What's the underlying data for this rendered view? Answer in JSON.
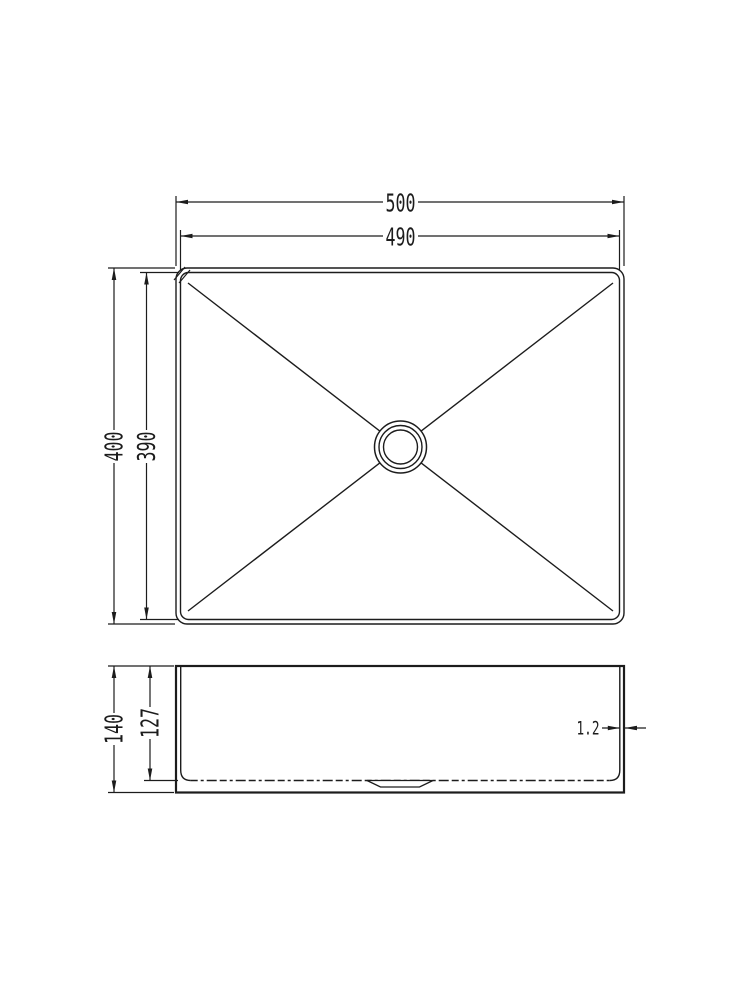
{
  "drawing": {
    "type": "technical-dimension-drawing",
    "subject": "rectangular-sink",
    "colors": {
      "line": "#1c1c1c",
      "background": "#ffffff"
    },
    "top_view": {
      "dim_outer_width": "500",
      "dim_inner_width": "490",
      "dim_outer_height": "400",
      "dim_inner_height": "390"
    },
    "side_view": {
      "dim_outer_height": "140",
      "dim_inner_depth": "127",
      "dim_wall_thickness": "1.2"
    }
  }
}
